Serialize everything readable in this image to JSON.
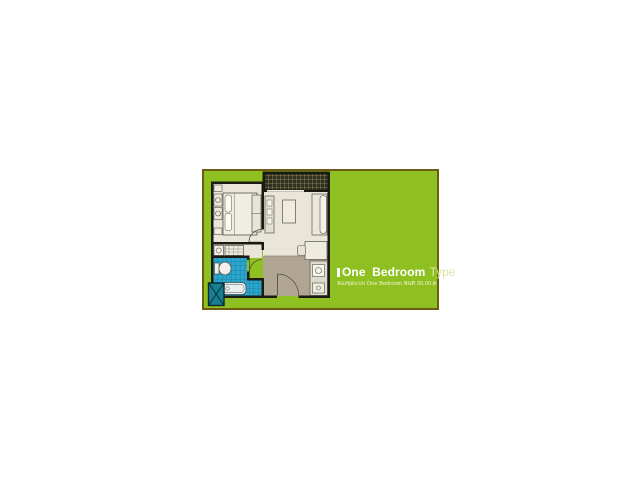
{
  "window": {
    "width": 640,
    "height": 480,
    "background": "#ffffff"
  },
  "card": {
    "background": "#8fc021",
    "border_color": "#6f5c12",
    "title": {
      "bullet_icon": "white-bar-bullet",
      "main": "One Bedroom",
      "secondary": "Type",
      "main_color": "#ffffff",
      "secondary_color": "#d9e7a4"
    },
    "subtitle": {
      "text": "ห้องชุดแบบ One Bedroom พื้นที่ 30.00 ตร.ม.",
      "color": "#f2f6d8"
    }
  },
  "floor_plan": {
    "semantic_name": "one-bedroom-unit-floor-plan",
    "rooms": [
      "bedroom",
      "living-area",
      "balcony",
      "bathroom",
      "entry-hall",
      "kitchen",
      "ac-ledge"
    ],
    "colors": {
      "wall": "#1a1a12",
      "room_floor": "#e9e5d8",
      "hall_floor": "#b1a694",
      "bathroom_tile": "#2ba5cb",
      "bathroom_tile_grid": "#16769a",
      "balcony_tile": "#30301f",
      "balcony_tile_grid": "#9c9668",
      "ac_ledge": "#187e92",
      "furniture_fill": "#efebdf",
      "furniture_stroke": "#55544a"
    }
  }
}
